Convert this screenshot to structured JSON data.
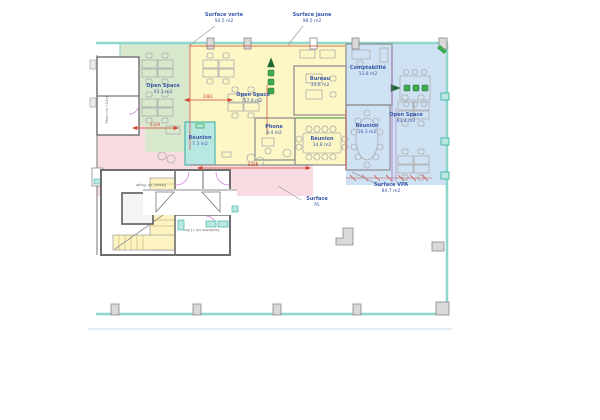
{
  "plan": {
    "title": "floor-plan-rdj",
    "surfaces": [
      {
        "id": "verte",
        "label": "Surface verte",
        "area": "50.5 m2"
      },
      {
        "id": "jaune",
        "label": "Surface jaune",
        "area": "98.5 m2"
      },
      {
        "id": "vpa",
        "label": "Surface VPA",
        "area": "84.7 m2"
      },
      {
        "id": "bottom",
        "label": "Surface",
        "area": "76."
      }
    ],
    "rooms": [
      {
        "id": "open-space-green",
        "label": "Open Space",
        "area": "43.5 m2"
      },
      {
        "id": "open-space-yellow",
        "label": "Open Space",
        "area": "57.0 m2"
      },
      {
        "id": "bureau",
        "label": "Bureau",
        "area": "33.6 m2"
      },
      {
        "id": "comptabilite",
        "label": "Comptabilité",
        "area": "13.8 m2"
      },
      {
        "id": "reunion-small",
        "label": "Réunion",
        "area": "7.3 m2"
      },
      {
        "id": "phone",
        "label": "Phone",
        "area": "8.4 m2"
      },
      {
        "id": "reunion-yellow",
        "label": "Réunion",
        "area": "14.8 m2"
      },
      {
        "id": "reunion-blue",
        "label": "Réunion",
        "area": "16.3 m2"
      },
      {
        "id": "open-space-blue",
        "label": "Open Space",
        "area": "63.4 m2"
      }
    ],
    "core_labels": [
      {
        "id": "depart",
        "text": "Départ 1er Étage"
      },
      {
        "id": "palier",
        "text": "Palier rdj +13m"
      },
      {
        "id": "sanitaires",
        "text": "Sanitaires rdj +13m"
      }
    ],
    "dimensions": [
      {
        "id": "d1",
        "value": "4229"
      },
      {
        "id": "d2",
        "value": "8288"
      },
      {
        "id": "d3",
        "value": "2081"
      }
    ],
    "colors": {
      "outline_teal": "#8fd6cc",
      "zone_green": "#d7e8cc",
      "zone_yellow": "#fcf7c5",
      "zone_blue": "#cfe2f4",
      "zone_pink": "#f8dce2",
      "room_teal": "#b9e7e1",
      "label_blue": "#3a57a7",
      "dimension_red": "#d2422f",
      "dimension_purple": "#b05fc0",
      "door_magenta": "#cf6fd0",
      "wall_gray": "#8c8c8c",
      "chair_green": "#3faa4f"
    }
  }
}
